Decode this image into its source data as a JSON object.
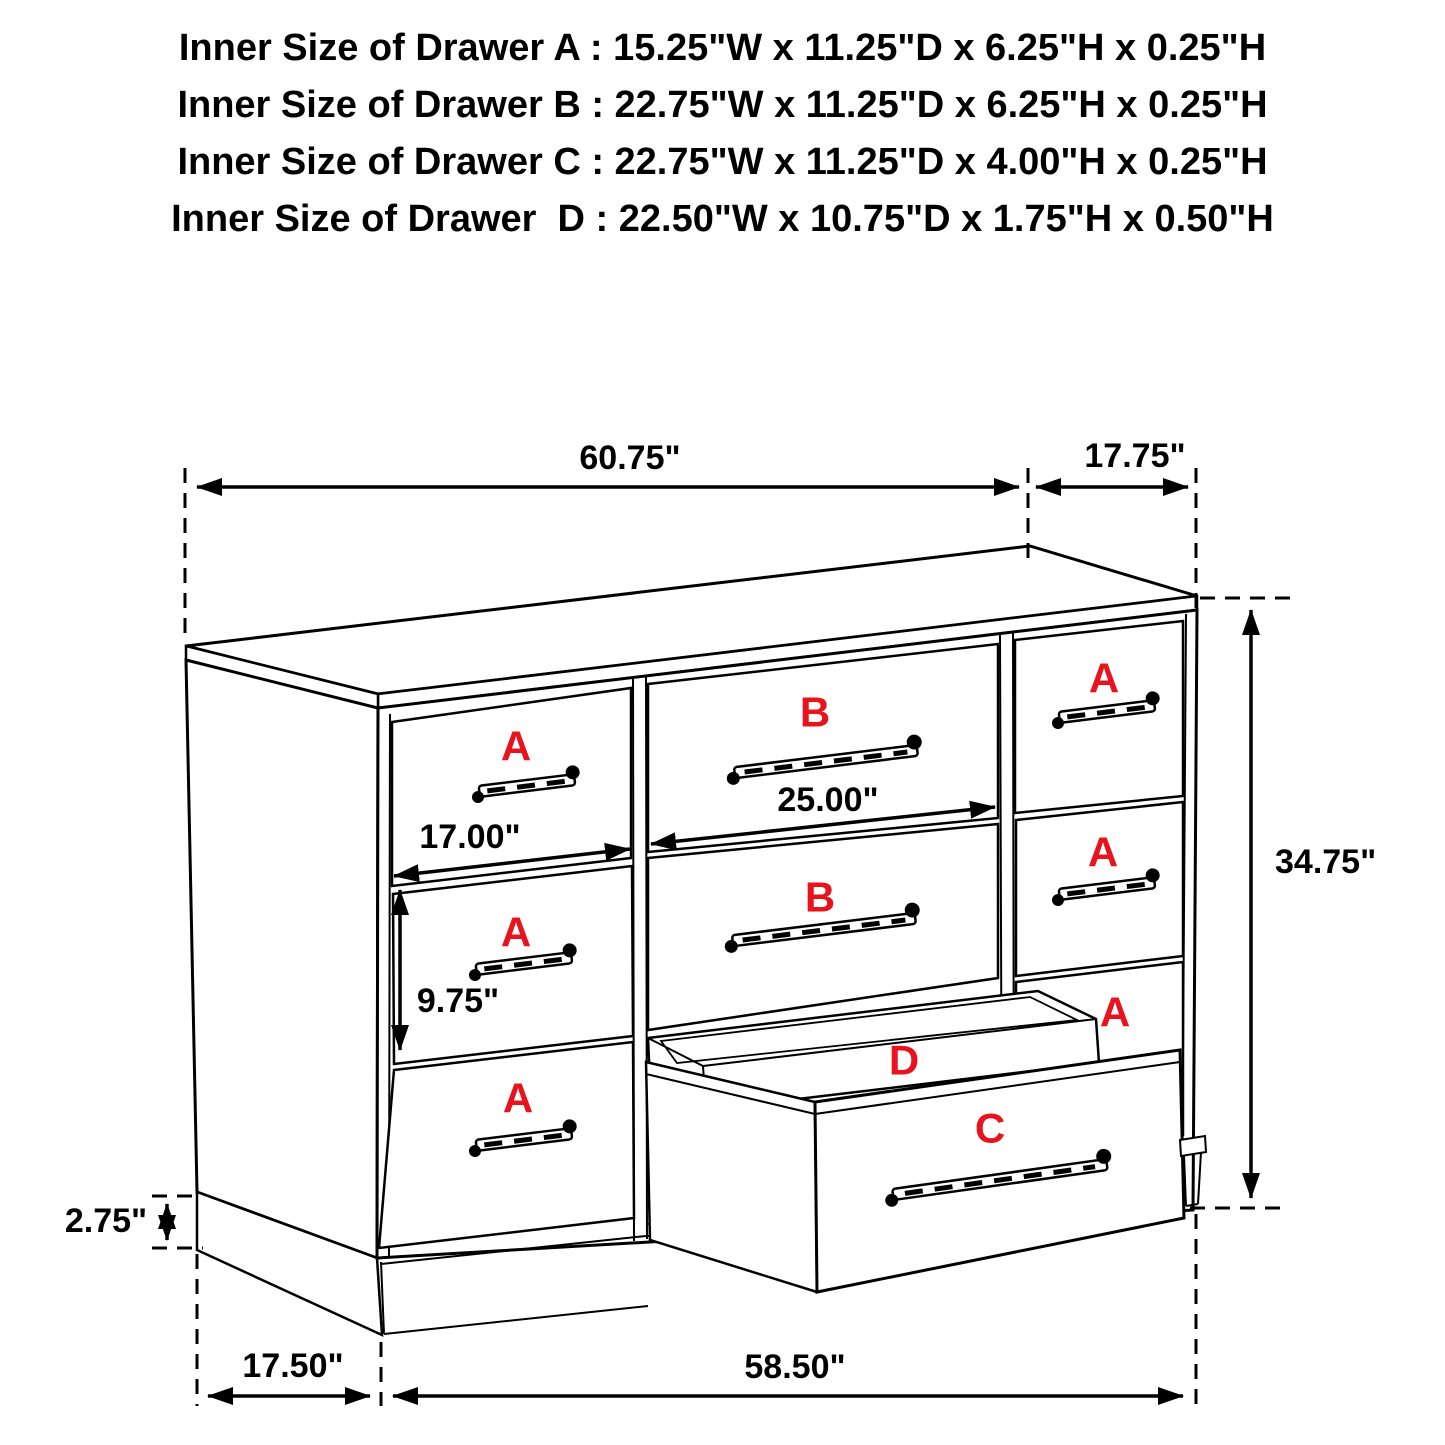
{
  "header": {
    "lines": [
      "Inner Size of Drawer A : 15.25\"W x 11.25\"D x 6.25\"H x 0.25\"H",
      "Inner Size of Drawer B : 22.75\"W x 11.25\"D x 6.25\"H x 0.25\"H",
      "Inner Size of Drawer C : 22.75\"W x 11.25\"D x 4.00\"H x 0.25\"H",
      "Inner Size of Drawer  D : 22.50\"W x 10.75\"D x 1.75\"H x 0.50\"H"
    ]
  },
  "diagram": {
    "type": "dresser-dimension-line-drawing",
    "dimensions": {
      "top_width": "60.75\"",
      "top_depth": "17.75\"",
      "overall_height": "34.75\"",
      "drawer_b_width": "25.00\"",
      "drawer_a_width": "17.00\"",
      "drawer_a_front_height": "9.75\"",
      "base_height": "2.75\"",
      "base_depth": "17.50\"",
      "base_width": "58.50\""
    },
    "drawer_labels": {
      "a": "A",
      "b": "B",
      "c": "C",
      "d": "D"
    },
    "colors": {
      "label_red": "#e8131c",
      "line_black": "#000000",
      "background": "#ffffff"
    }
  }
}
